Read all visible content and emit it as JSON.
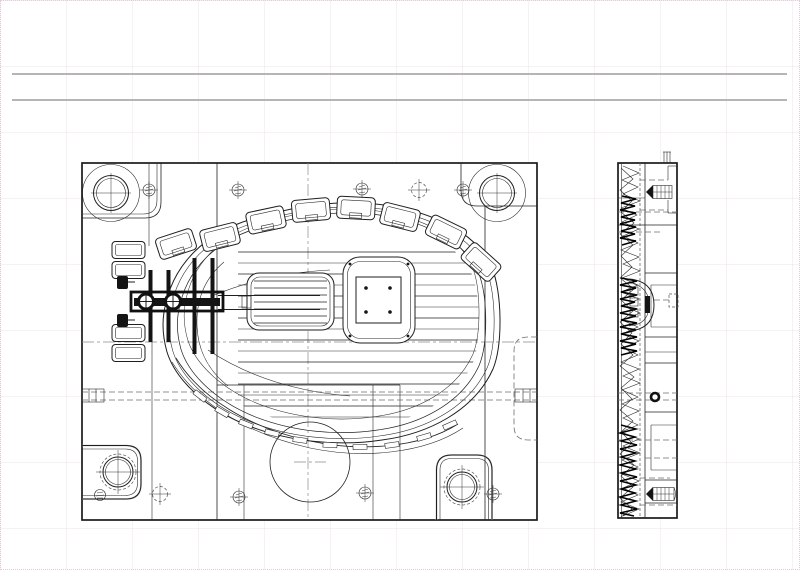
{
  "page": {
    "width": 800,
    "height": 570,
    "background": "#ffffff",
    "margin_border_color": "#e6c9d8",
    "grid_color": "#e1cdd7",
    "header_rule_color": "#b5b5b5",
    "header_rules_y": [
      74,
      100
    ]
  },
  "drawing": {
    "type": "cad-technical-drawing",
    "subject": "injection mold plate with shoe-sole cavity, plan view and side section view",
    "text_labels": [],
    "line_color": "#1f1f1f",
    "hidden_line_color": "#6f6f6f",
    "centerline_color": "#8a8a8a",
    "solid_fill_color": "#141414",
    "views": [
      {
        "name": "plan-view",
        "x": 82,
        "y": 163,
        "width": 455,
        "height": 357,
        "features": {
          "corner_guide_holes": 2,
          "corner_guide_blocks": 2,
          "vent_bosses_along_top_arc": 8,
          "vent_bosses_left_stack": 4,
          "sole_outline_contours": 4,
          "tread_rib_lines": 16,
          "rib_insert_block": 1,
          "square_insert_frame": 1,
          "runner_bar_screws": 2,
          "small_screw_marks": 7,
          "dashed_center_marks": 2,
          "ejector_circle_radius": 40,
          "cooling_line_y": 396,
          "centerline_x": 308,
          "centerline_y": 342
        }
      },
      {
        "name": "side-view",
        "x": 618,
        "y": 163,
        "width": 59,
        "height": 355,
        "features": {
          "clamp_screws": 2,
          "dowel_pins": 1,
          "gate_arch": 1,
          "parting_profile_band": "dense scribble along left edge"
        }
      }
    ]
  }
}
